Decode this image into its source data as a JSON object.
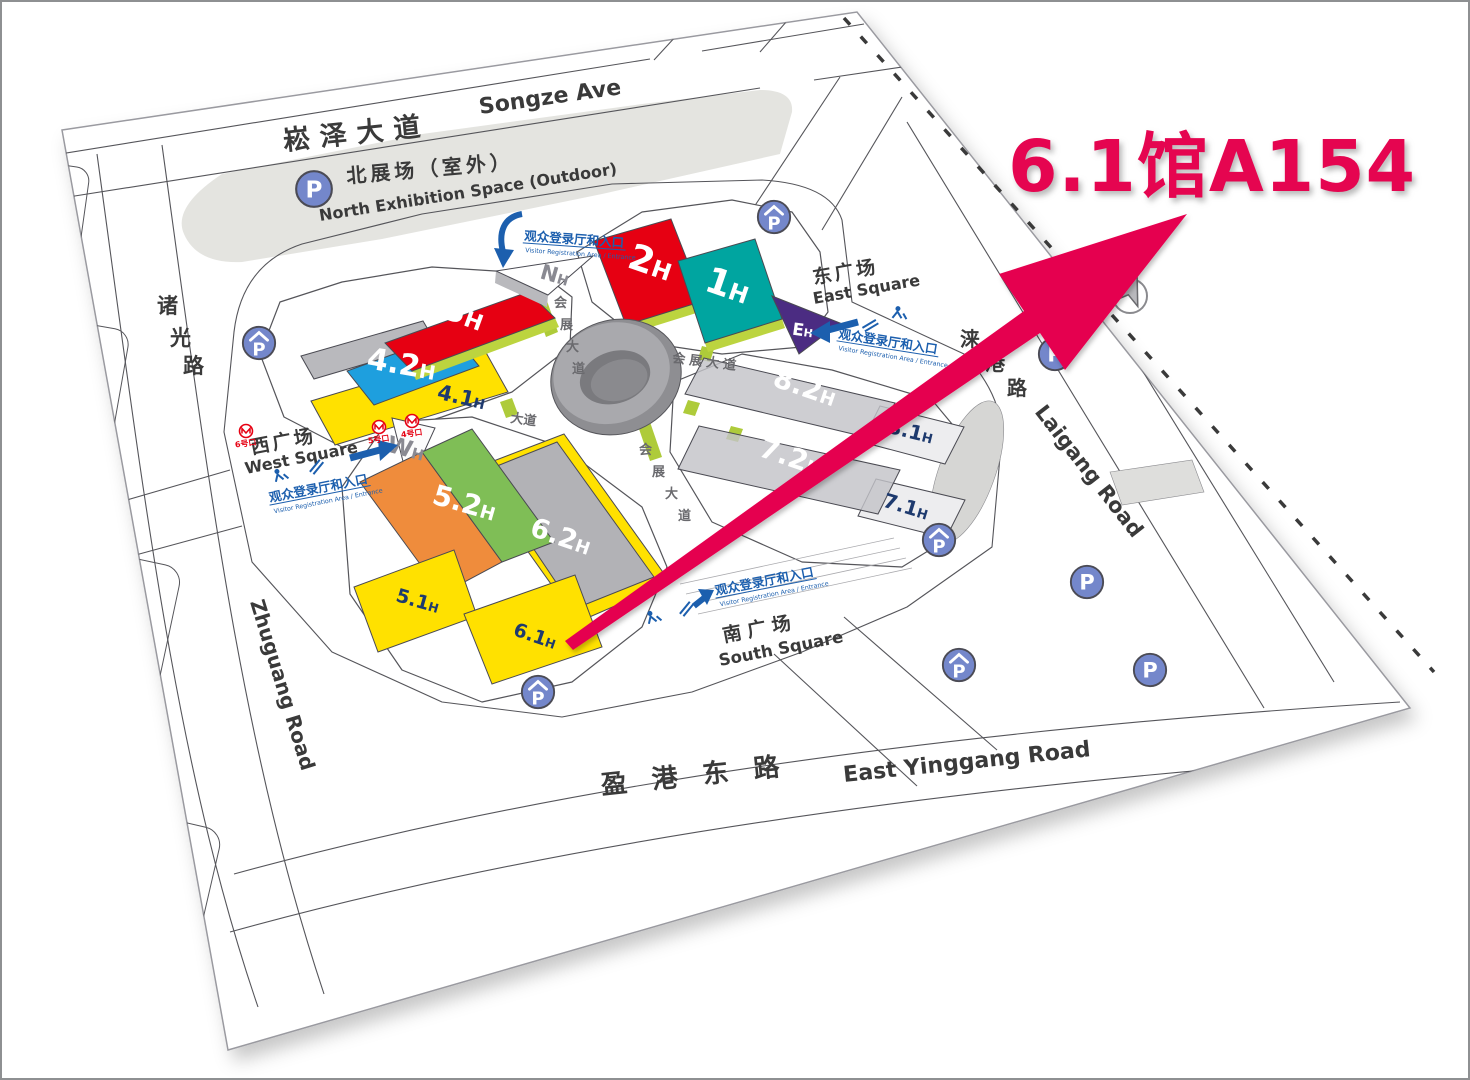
{
  "headline": {
    "text": "6.1馆A154"
  },
  "colors": {
    "accent_pink": "#e50550",
    "hall_red": "#e60012",
    "hall_teal": "#00a5a0",
    "hall_blue": "#1e9fde",
    "hall_yellow": "#ffe100",
    "hall_orange": "#ef8c3c",
    "hall_green": "#7fbe56",
    "hall_purple": "#4b2c82",
    "registration_blue": "#1c5fae",
    "parking_blue": "#7487cb",
    "metro_red": "#e60012",
    "label_navy": "#1e3a6e"
  },
  "map": {
    "roads": {
      "songze_cn": "崧泽大道",
      "songze_en": "Songze Ave",
      "zhuguang_chars": [
        "诸",
        "光",
        "路"
      ],
      "zhuguang_en": "Zhuguang Road",
      "yinggang_cn": "盈 港 东 路",
      "yinggang_en": "East Yinggang Road",
      "laigang_chars": [
        "涞",
        "港",
        "路"
      ],
      "laigang_en": "Laigang Road",
      "huizhan_chars": [
        "会",
        "展",
        "大",
        "道"
      ],
      "huizhan_cn": "会展大道",
      "dadao": "大道"
    },
    "areas": {
      "north_cn": "北展场（室外）",
      "north_en": "North Exhibition Space (Outdoor)",
      "east_cn": "东广场",
      "east_en": "East Square",
      "west_cn": "西广场",
      "west_en": "West Square",
      "south_cn": "南广场",
      "south_en": "South Square"
    },
    "halls": {
      "h1": {
        "num": "1",
        "suf": "H"
      },
      "h2": {
        "num": "2",
        "suf": "H"
      },
      "h3": {
        "num": "3",
        "suf": "H"
      },
      "h42": {
        "num": "4.2",
        "suf": "H"
      },
      "h41": {
        "num": "4.1",
        "suf": "H"
      },
      "h52": {
        "num": "5.2",
        "suf": "H"
      },
      "h51": {
        "num": "5.1",
        "suf": "H"
      },
      "h62": {
        "num": "6.2",
        "suf": "H"
      },
      "h61": {
        "num": "6.1",
        "suf": "H"
      },
      "h82": {
        "num": "8.2",
        "suf": "H"
      },
      "h81": {
        "num": "8.1",
        "suf": "H"
      },
      "h72": {
        "num": "7.2",
        "suf": "H"
      },
      "h71": {
        "num": "7.1",
        "suf": "H"
      },
      "hn": {
        "num": "N",
        "suf": "H"
      },
      "hw": {
        "num": "W",
        "suf": "H"
      },
      "he": {
        "num": "E",
        "suf": "H"
      }
    },
    "registration": {
      "cn": "观众登录厅和入口",
      "en": "Visitor Registration Area / Entrance"
    },
    "metro": {
      "e6": "6号口",
      "e5": "5号口",
      "e4": "4号口"
    },
    "parking": "P",
    "compass_n": "N"
  }
}
